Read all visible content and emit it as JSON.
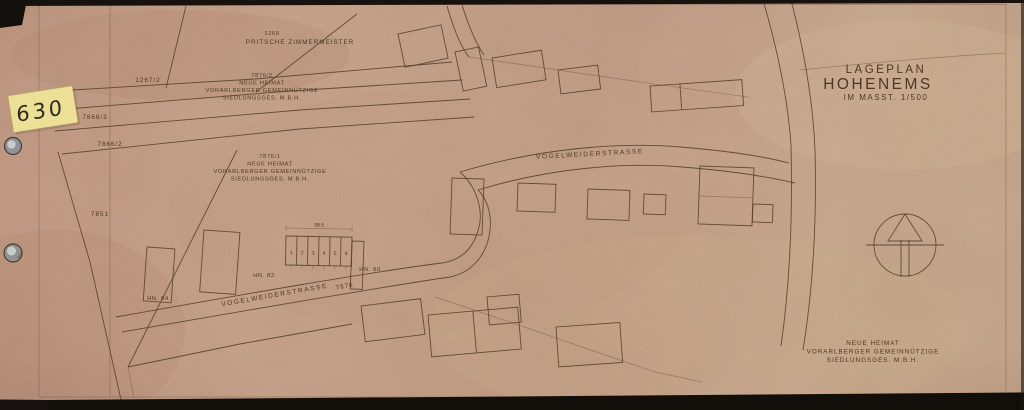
{
  "document": {
    "sticker_number": "630",
    "title": {
      "line1": "LAGEPLAN",
      "line2": "HOHENEMS",
      "line3": "IM MASST. 1/500"
    },
    "company": {
      "line1": "NEUE HEIMAT",
      "line2": "VORARLBERGER GEMEINNÜTZIGE",
      "line3": "SIEDLUNGSGES. M.B.H."
    },
    "parcels": {
      "p1269": "1269",
      "p1269_owner": "PRITSCHE ZIMMERMEISTER",
      "p1267_2": "1267/2",
      "p7876_2": "7876/2",
      "p7866_3": "7866/3",
      "p7866_2": "7866/2",
      "p7851": "7851",
      "p7876_1": "7876/1",
      "p7876_street": "7876"
    },
    "streets": {
      "upper": "VOGELWEIDERSTRASSE",
      "lower": "VOGELWEIDERSTRASSE"
    },
    "house_numbers": {
      "hn84": "HN. 84",
      "hn82": "HN. 82",
      "hn80": "HN. 80"
    },
    "units": [
      "1",
      "2",
      "3",
      "4",
      "5",
      "6"
    ],
    "dimension_top": "38.5",
    "colors": {
      "paper": "#c9a68d",
      "ink": "#55402c",
      "sticker": "#ecdf96",
      "scan_edge": "#15110d"
    }
  }
}
